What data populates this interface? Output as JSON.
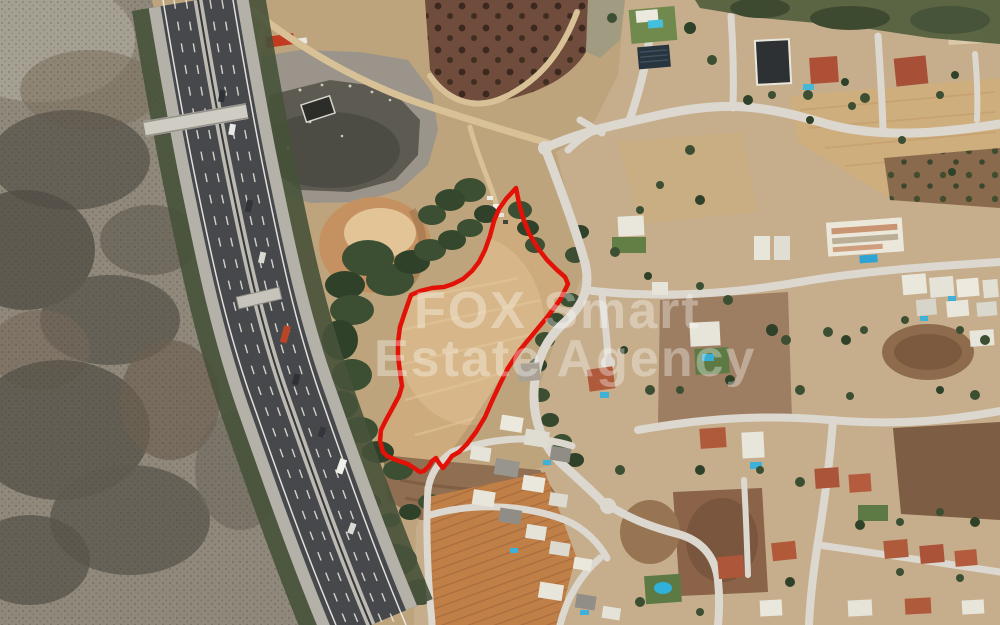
{
  "watermark": {
    "line1": "FOX Smart",
    "line2": "Estate Agency",
    "color": "#ffffff"
  },
  "plot_outline": {
    "color": "#e21208",
    "points": "516,188 519,203 523,218 529,233 537,247 547,260 557,270 565,277 568,284 560,300 548,316 534,333 520,350 508,368 500,384 492,401 485,417 476,432 467,444 459,452 452,456 447,463 443,468 439,463 436,458 432,461 429,466 424,471 420,472 408,464 396,460 387,456 383,452 380,441 381,430 386,420 392,409 399,396 402,386 400,372 398,356 398,342 400,327 405,312 411,295 420,291 432,288 444,287 453,284 463,279 472,271 479,262 485,250 490,236 494,221 499,209 506,199"
  },
  "palette": {
    "scrubland": "#8f887b",
    "dirt": "#bda47c",
    "plot_field": "#cdab7d",
    "highway_asphalt": "#46484c",
    "street": "#dcd8d0",
    "trees": "#3c4f33",
    "orchard": "#6f4c3b",
    "terracotta_roof": "#b05a3c",
    "pool_water": "#3fb0d8"
  }
}
